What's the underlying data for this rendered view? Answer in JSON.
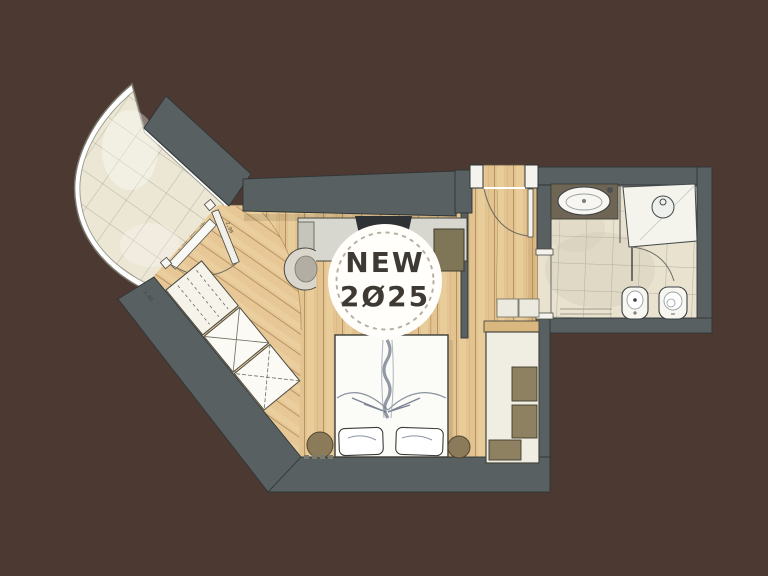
{
  "scene": {
    "title": "hotel-room-floor-plan",
    "badge": {
      "line1": "NEW",
      "line2": "2Ø25"
    },
    "dimension_labels": {
      "balcony_door": "2,00",
      "lower_window": "2,00"
    }
  },
  "colors": {
    "background": "#4c3931",
    "wall": "#586061",
    "wall_outline": "#303637",
    "wood": "#e3c390",
    "wood_line": "#8a6434",
    "tile_bathroom": "#e8e2cf",
    "tile_balcony": "#ece6d4",
    "tile_line": "#a5a492",
    "white_fixture": "#f8f7f2",
    "cushion": "#8d8162",
    "stool": "#8c7b5a",
    "counter": "#6f6555",
    "tv": "#2e3234",
    "badge_bg": "#fffefa",
    "badge_border": "#b7b0a5",
    "badge_text": "#3e3933"
  },
  "rooms": [
    {
      "name": "balcony-terrace"
    },
    {
      "name": "bedroom"
    },
    {
      "name": "entry-corridor"
    },
    {
      "name": "bathroom"
    }
  ],
  "furniture": [
    {
      "name": "double-bed"
    },
    {
      "name": "round-stool-left"
    },
    {
      "name": "round-stool-right"
    },
    {
      "name": "daybed-bench"
    },
    {
      "name": "wardrobe"
    },
    {
      "name": "desk-with-tv"
    },
    {
      "name": "armchair"
    },
    {
      "name": "minibar-cabinet"
    },
    {
      "name": "vanity-sink"
    },
    {
      "name": "shower"
    },
    {
      "name": "bidet"
    },
    {
      "name": "toilet"
    }
  ]
}
